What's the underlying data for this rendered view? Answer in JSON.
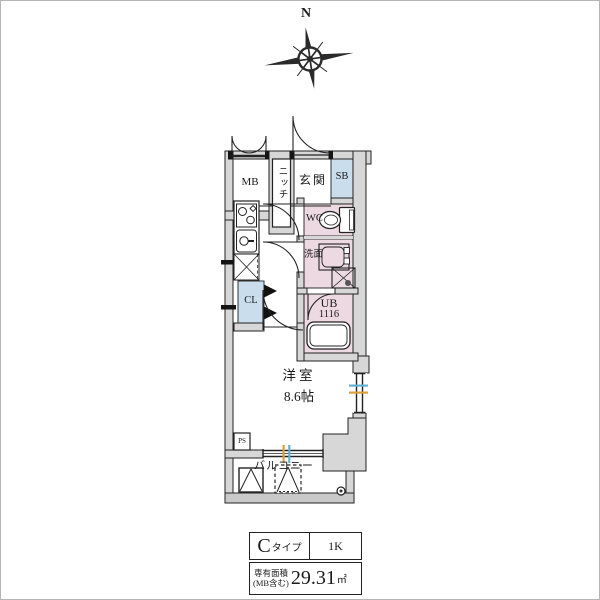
{
  "compass": {
    "north_label": "N"
  },
  "plan": {
    "labels": {
      "mb": "MB",
      "niche": "ニッチ",
      "entrance": "玄関",
      "shoe_box": "SB",
      "wc": "WC",
      "washroom": "洗面",
      "unit_bath": "UB",
      "unit_bath_size": "1116",
      "closet": "CL",
      "pipe_space": "PS",
      "main_room": "洋室",
      "main_room_size": "8.6帖",
      "balcony": "バルコニー"
    },
    "colors": {
      "wall_fill": "#d7d7d7",
      "rail_fill": "#c9c9c9",
      "wet_area_fill": "#edd9e2",
      "storage_fill": "#cadded",
      "window_tick_blue": "#62b0d2",
      "window_tick_orange": "#dd9f3e"
    }
  },
  "spec_table": {
    "type_letter": "C",
    "type_suffix": "タイプ",
    "layout": "1K",
    "area_label_line1": "専有面積",
    "area_label_line2": "(MB含む)",
    "area_value": "29.31",
    "area_unit": "㎡"
  }
}
